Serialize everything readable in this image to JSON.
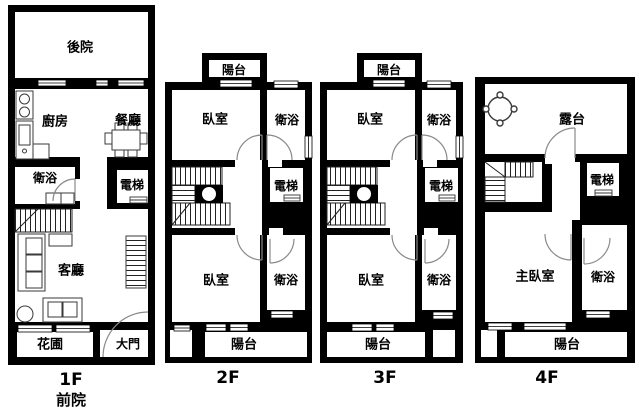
{
  "floors": [
    {
      "label": "1F",
      "sublabel": "前院",
      "rooms": {
        "backyard": "後院",
        "kitchen": "廚房",
        "dining": "餐廳",
        "bathroom": "衛浴",
        "elevator": "電梯",
        "living": "客廳",
        "flower_bed": "花圃",
        "main_door": "大門"
      }
    },
    {
      "label": "2F",
      "rooms": {
        "balcony_top": "陽台",
        "bedroom_top": "臥室",
        "bathroom_top": "衛浴",
        "elevator": "電梯",
        "bedroom_bottom": "臥室",
        "bathroom_bottom": "衛浴",
        "balcony_bottom": "陽台"
      }
    },
    {
      "label": "3F",
      "rooms": {
        "balcony_top": "陽台",
        "bedroom_top": "臥室",
        "bathroom_top": "衛浴",
        "elevator": "電梯",
        "bedroom_bottom": "臥室",
        "bathroom_bottom": "衛浴",
        "balcony_bottom": "陽台"
      }
    },
    {
      "label": "4F",
      "rooms": {
        "terrace": "露台",
        "elevator": "電梯",
        "master_bedroom": "主臥室",
        "bathroom": "衛浴",
        "balcony": "陽台"
      }
    }
  ],
  "colors": {
    "wall": "#000000",
    "background": "#ffffff",
    "furniture": "#3a3a3a",
    "door_arc": "#8a8a8a"
  }
}
